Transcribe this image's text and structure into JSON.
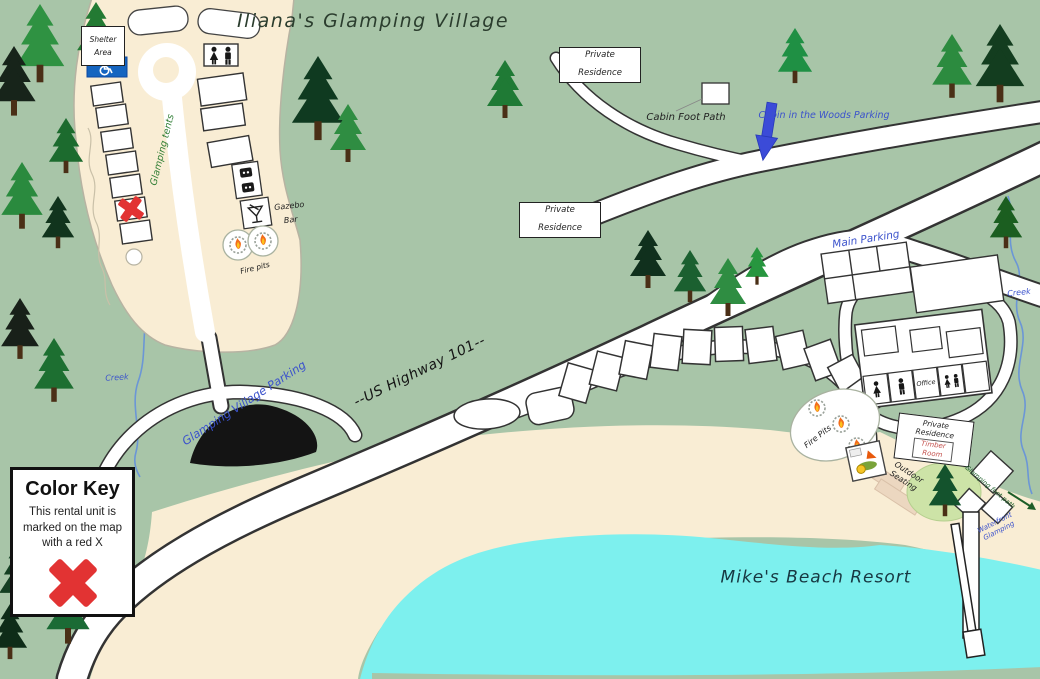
{
  "title": "Iliana's Glamping Village",
  "labels": {
    "shelter_area": "Shelter Area",
    "glamping_tents": "Glamping tents",
    "gazebo_bar": "Gazebo Bar",
    "fire_pits_glamping": "Fire pits",
    "glamping_village_parking": "Glamping Village Parking",
    "highway": "--US Highway 101--",
    "private_residence": "Private Residence",
    "cabin_foot_path": "Cabin Foot Path",
    "cabin_woods_parking": "Cabin in the Woods Parking",
    "main_parking": "Main Parking",
    "creek": "Creek",
    "office": "Office",
    "fire_pits_beach": "Fire Pits",
    "timber_room": "Timber Room",
    "outdoor_seating": "Outdoor Seating",
    "waterfront_glamping": "Waterfront Glamping",
    "glamping_foot_path": "Glamping foot path",
    "beach_resort": "Mike's Beach Resort"
  },
  "color_key": {
    "title": "Color Key",
    "description": "This rental unit is marked on the map with a red X"
  },
  "colors": {
    "background_green": "#a8c5a8",
    "sand": "#f9edd4",
    "water": "#7df0ee",
    "road": "#ffffff",
    "road_outline": "#333333",
    "label_blue": "#3b52cc",
    "label_green": "#2f7d33",
    "red_x": "#e23333",
    "timber_room_text": "#c4524e",
    "accessible_sign_blue": "#1565c0",
    "black_structure": "#141414",
    "grass_circle": "#cde3a7"
  },
  "icons": {
    "wheelchair-icon": "accessible parking symbol",
    "restroom-icon": "male and female figures",
    "martini-icon": "cocktail glass marking gazebo bar",
    "flame-icon": "campfire flame on stone fire pit",
    "location-arrow-icon": "blue downward arrow",
    "red-x-icon": "red X marking rental unit",
    "pine-tree-icon": "evergreen tree"
  }
}
